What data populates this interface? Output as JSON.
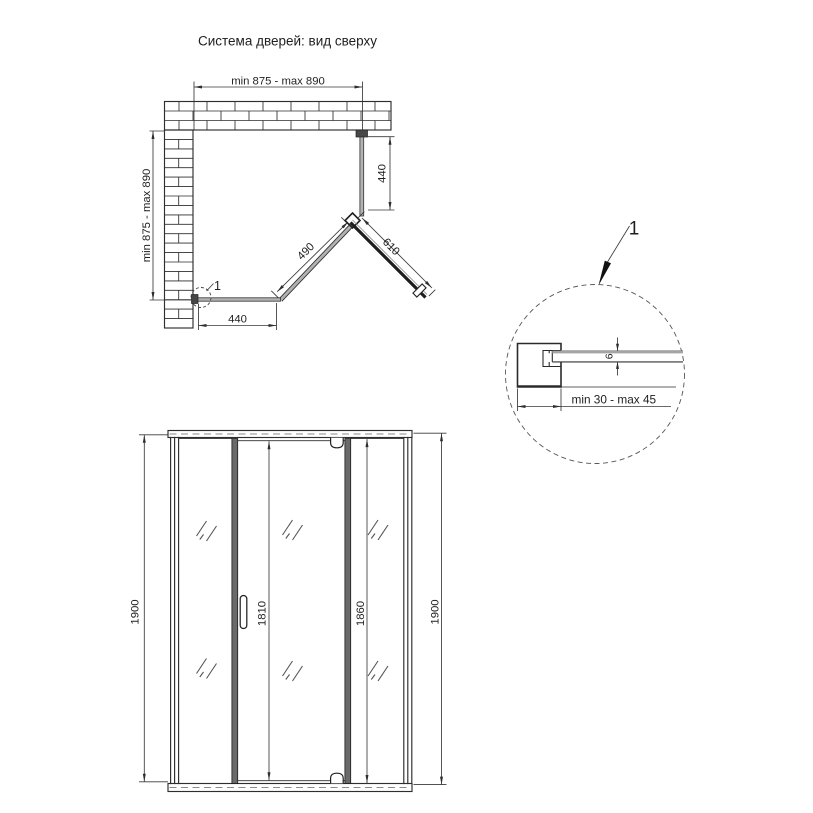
{
  "title": "Система дверей: вид сверху",
  "top_view": {
    "dim_width_top": "min 875 - max 890",
    "dim_depth_left": "min 875 - max 890",
    "dim_side_panel_right": "440",
    "dim_side_panel_bottom": "440",
    "dim_fixed_diagonal": "490",
    "dim_door_diagonal": "610",
    "detail_marker": "1"
  },
  "detail_view": {
    "callout_label": "1",
    "dim_glass_thickness": "6",
    "dim_wall_profile": "min 30 - max 45"
  },
  "front_view": {
    "dim_height_left": "1900",
    "dim_door_height": "1810",
    "dim_glass_height": "1860",
    "dim_height_right": "1900"
  },
  "colors": {
    "line": "#2e2e2e",
    "dim_line": "#3a3a3a",
    "glass_fill": "#b2b2b2",
    "profile_fill": "#6a6a6a",
    "background": "#ffffff"
  }
}
